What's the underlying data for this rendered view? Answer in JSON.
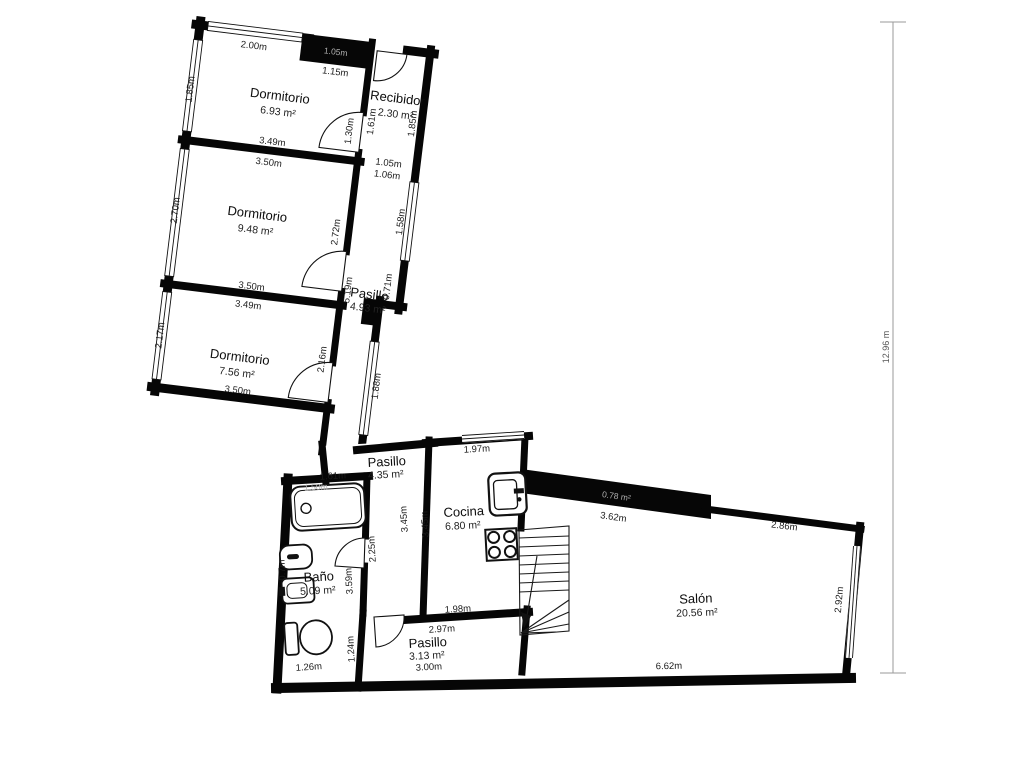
{
  "title": "Floor plan",
  "rooms": {
    "dorm1": {
      "name": "Dormitorio",
      "area": "6.93 m²"
    },
    "recibidor": {
      "name": "Recibidor",
      "area": "2.30 m²"
    },
    "dorm2": {
      "name": "Dormitorio",
      "area": "9.48 m²"
    },
    "dorm3": {
      "name": "Dormitorio",
      "area": "7.56 m²"
    },
    "pasillo1": {
      "name": "Pasillo",
      "area": "4.93 m²"
    },
    "pasillo2": {
      "name": "Pasillo",
      "area": "4.35 m²"
    },
    "cocina": {
      "name": "Cocina",
      "area": "6.80 m²"
    },
    "bano": {
      "name": "Baño",
      "area": "5.09 m²"
    },
    "pasillo3": {
      "name": "Pasillo",
      "area": "3.13 m²"
    },
    "salon": {
      "name": "Salón",
      "area": "20.56 m²"
    },
    "closet": {
      "area": "0.78 m²"
    }
  },
  "dims": {
    "d1_top": "2.00m",
    "d1_closet": "1.05m",
    "d1_topseg": "1.15m",
    "d1_left": "1.85m",
    "d1_bottom": "3.49m",
    "d1_door": "1.30m",
    "rec_left": "1.61m",
    "rec_right": "1.85m",
    "pass_w1": "1.05m",
    "pass_w2": "1.06m",
    "d2_top": "3.50m",
    "d2_left": "2.70m",
    "d2_right": "2.72m",
    "d2_bottom": "3.50m",
    "d3_top": "3.49m",
    "d3_left": "2.17m",
    "d3_right": "2.16m",
    "d3_bottom": "3.50m",
    "p1_len": "5.19m",
    "p1_w": "0.71m",
    "p1_win1": "1.58m",
    "p1_win2": "1.88m",
    "p2_top": "1.61m",
    "bano_top": "1.50m",
    "corr": "2.25m",
    "coc_w": "3.45m",
    "coc_e": "3.45m",
    "coc_top": "1.97m",
    "bano_left": "0.7m",
    "bano_right": "3.59m",
    "corr2": "1.24m",
    "bano_bottom": "1.26m",
    "coc_bottom": "1.98m",
    "p3_top": "2.97m",
    "p3_bottom": "3.00m",
    "sal_nw": "3.62m",
    "sal_ne": "2.86m",
    "sal_e": "2.92m",
    "sal_s": "6.62m"
  },
  "ruler": {
    "total": "12.96 m"
  },
  "colors": {
    "wall": "#060606",
    "floor": "#ffffff",
    "dim_text": "#1b1b1b",
    "faint_wall_text": "#b0b0b0"
  }
}
